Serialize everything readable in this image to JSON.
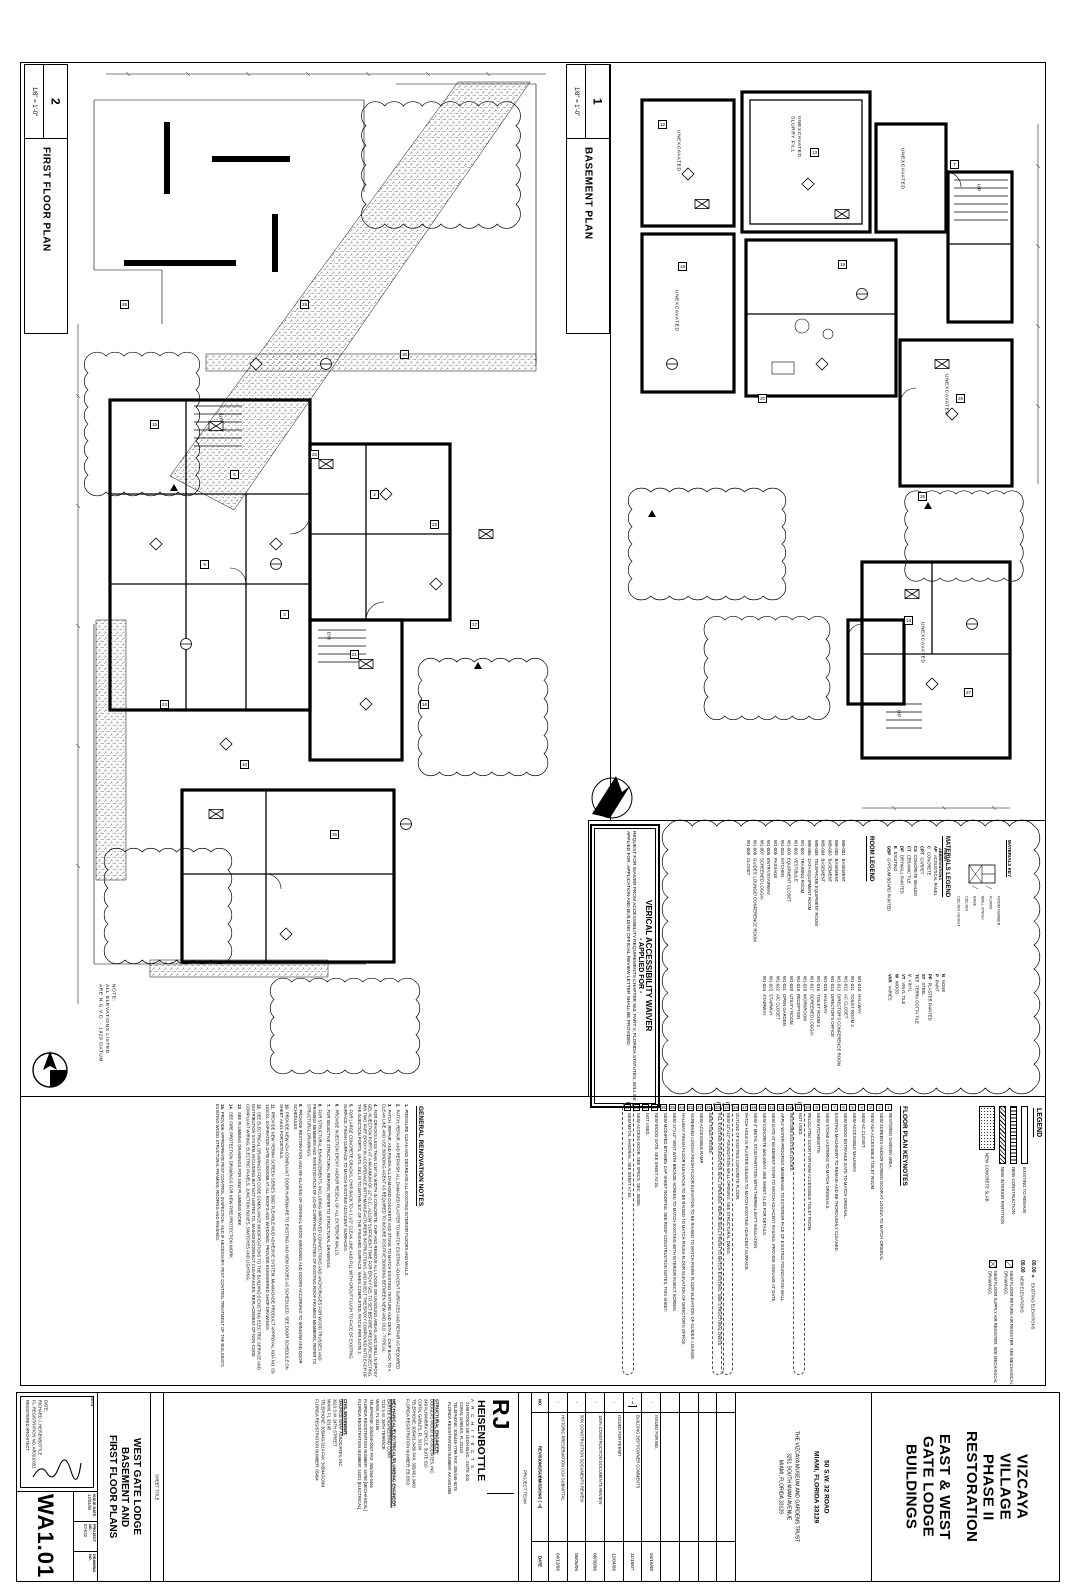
{
  "plans": {
    "first_floor": {
      "number": "2",
      "title": "FIRST FLOOR PLAN",
      "scale": "1/8\" = 1'-0\"",
      "labels": [
        {
          "text": "NOTE:\nALL ELEVATIONS LISTED\nARE N.G.V.D. - 1929 DATUM.",
          "x": 30,
          "y": 920
        },
        {
          "text": "UP",
          "x": 150,
          "y": 350
        },
        {
          "text": "DN",
          "x": 258,
          "y": 568
        }
      ],
      "tags": [
        {
          "n": "15",
          "x": 84,
          "y": 356
        },
        {
          "n": "5",
          "x": 164,
          "y": 406
        },
        {
          "n": "22",
          "x": 244,
          "y": 386
        },
        {
          "n": "2",
          "x": 304,
          "y": 426
        },
        {
          "n": "23",
          "x": 364,
          "y": 456
        },
        {
          "n": "9",
          "x": 134,
          "y": 496
        },
        {
          "n": "3",
          "x": 214,
          "y": 546
        },
        {
          "n": "21",
          "x": 284,
          "y": 586
        },
        {
          "n": "24",
          "x": 94,
          "y": 636
        },
        {
          "n": "10",
          "x": 174,
          "y": 696
        },
        {
          "n": "25",
          "x": 264,
          "y": 766
        },
        {
          "n": "16",
          "x": 354,
          "y": 636
        },
        {
          "n": "26",
          "x": 54,
          "y": 236
        },
        {
          "n": "29",
          "x": 234,
          "y": 236
        },
        {
          "n": "30",
          "x": 334,
          "y": 286
        },
        {
          "n": "17",
          "x": 404,
          "y": 556
        },
        {
          "n": "",
          "cls": "tri",
          "x": 104,
          "y": 420
        },
        {
          "n": "",
          "cls": "tri",
          "x": 408,
          "y": 598
        }
      ]
    },
    "basement": {
      "number": "1",
      "title": "BASEMENT PLAN",
      "scale": "1/8\" = 1'-0\"",
      "labels": [
        {
          "text": "UNEXCAVATED",
          "x": 62,
          "y": 66
        },
        {
          "text": "UNEXCAVATED\nSLURRY FILL",
          "x": 176,
          "y": 52
        },
        {
          "text": "UNEXCAVATED",
          "x": 60,
          "y": 226
        },
        {
          "text": "UNEXCAVATED",
          "x": 286,
          "y": 84
        },
        {
          "text": "UNEXCAVATED",
          "x": 330,
          "y": 310
        },
        {
          "text": "UNEXCAVATED",
          "x": 306,
          "y": 558
        },
        {
          "text": "UP",
          "x": 362,
          "y": 120
        },
        {
          "text": "UP",
          "x": 282,
          "y": 646
        }
      ],
      "tags": [
        {
          "n": "12",
          "x": 46,
          "y": 56
        },
        {
          "n": "13",
          "x": 198,
          "y": 84
        },
        {
          "n": "7",
          "x": 338,
          "y": 96
        },
        {
          "n": "18",
          "x": 66,
          "y": 198
        },
        {
          "n": "19",
          "x": 226,
          "y": 196
        },
        {
          "n": "25",
          "x": 344,
          "y": 330
        },
        {
          "n": "26",
          "x": 306,
          "y": 428
        },
        {
          "n": "20",
          "x": 146,
          "y": 330
        },
        {
          "n": "14",
          "x": 292,
          "y": 552
        },
        {
          "n": "27",
          "x": 352,
          "y": 624
        },
        {
          "n": "",
          "cls": "tri",
          "x": 36,
          "y": 446
        },
        {
          "n": "",
          "cls": "tri",
          "x": 312,
          "y": 438
        }
      ]
    }
  },
  "waiver": {
    "title": "VERICAL ACCESSIBILITY WAIVER",
    "subtitle": "- APPLIED FOR -",
    "body": "REQUEST FOR WAIVER FROM ACCESSIBILITY REQUIREMENTS CHAPTER 553, PART V, FLORIDA STATUTES, WILL BE APPLIED FOR. APPLICATION AND BUILDING OFFICIAL REVIEW LETTER SHALL BE PROVIDED."
  },
  "room_legend": {
    "title": "ROOM LEGEND",
    "group1": [
      {
        "no": "WB-001",
        "name": "BASEMENT"
      },
      {
        "no": "WB-002",
        "name": "BASEMENT"
      },
      {
        "no": "WB-003",
        "name": "BASEMENT"
      },
      {
        "no": "WB-004",
        "name": "BASEMENT"
      },
      {
        "no": "WB-005",
        "name": "TELEPHONE EQUIPMENT ROOM"
      },
      {
        "no": "WB-006",
        "name": "DATA EQUIPMENT ROOM"
      },
      {
        "no": "W1-001",
        "name": "TRAINING ROOM"
      },
      {
        "no": "W1-002",
        "name": "VESTIBULE"
      },
      {
        "no": "W1-003",
        "name": "EQUIPMENT CLOSET"
      },
      {
        "no": "W1-004",
        "name": "KITCHEN"
      },
      {
        "no": "W1-005",
        "name": "PASSAGE"
      },
      {
        "no": "W1-006",
        "name": "ENTRY/STAIRWAY"
      },
      {
        "no": "W1-007",
        "name": "SCREENED LOGGIA"
      },
      {
        "no": "W1-008",
        "name": "GUIDES' LOUNGE/ CONFERENCE ROOM"
      },
      {
        "no": "W1-009",
        "name": "CLOSET"
      }
    ],
    "group2": [
      {
        "no": "W1-010",
        "name": "HALLWAY"
      },
      {
        "no": "W1-011",
        "name": "TOILET ROOM 2"
      },
      {
        "no": "W1-012",
        "name": "AC CLOSET"
      },
      {
        "no": "W1-013",
        "name": "DIRECTOR'S CONFERENCE ROOM"
      },
      {
        "no": "W1-014",
        "name": "DIRECTOR'S OFFICE"
      },
      {
        "no": "W1-015",
        "name": "HALLWAY"
      },
      {
        "no": "W1-016",
        "name": "TOILET ROOM 1"
      },
      {
        "no": "W1-017",
        "name": "SCREENED LOGGIA"
      },
      {
        "no": "W1-018",
        "name": "WORKROOM"
      },
      {
        "no": "W1-019",
        "name": "RECEPTION"
      },
      {
        "no": "W1-020",
        "name": "UTILITY ROOM"
      },
      {
        "no": "W1-021",
        "name": "OPEN GARDEN"
      },
      {
        "no": "W1-022",
        "name": "A/C CLOSET"
      },
      {
        "no": "W1-023",
        "name": "STAIRWAY"
      },
      {
        "no": "W1-024",
        "name": "STAIRWAY"
      }
    ]
  },
  "materials_legend": {
    "title": "MATERIALS LEGEND",
    "col_header": "FINISH\nABBREVIATIONS",
    "materials": [
      {
        "abbr": "AP",
        "name": "ACOUSTICAL PANEL"
      },
      {
        "abbr": "C",
        "name": "CONCRETE"
      },
      {
        "abbr": "CPT",
        "name": "CARPET"
      },
      {
        "abbr": "CS",
        "name": "CONCRETE SEALED"
      },
      {
        "abbr": "CT",
        "name": "CERAMIC TILE"
      },
      {
        "abbr": "DP",
        "name": "DRYWALL PAINTED"
      },
      {
        "abbr": "E",
        "name": "EXISTING"
      },
      {
        "abbr": "GBP",
        "name": "GYPSUM BOARD PAINTED"
      }
    ],
    "finishes": [
      {
        "abbr": "N",
        "name": "NONE"
      },
      {
        "abbr": "P",
        "name": "PAINT"
      },
      {
        "abbr": "PP",
        "name": "PLASTER PAINTED"
      },
      {
        "abbr": "ST",
        "name": "STEEL"
      },
      {
        "abbr": "TCT",
        "name": "TERRA COTTA TILE"
      },
      {
        "abbr": "V",
        "name": "VINYL"
      },
      {
        "abbr": "VT",
        "name": "VINYL TILE"
      },
      {
        "abbr": "W",
        "name": "WOOD"
      },
      {
        "abbr": "VAR",
        "name": "VARIES"
      }
    ],
    "key": {
      "title": "MATERIALS KEY",
      "labels": [
        {
          "text": "ROOM NUMBER",
          "x": 42,
          "y": 58
        },
        {
          "text": "FLOOR",
          "x": 34,
          "y": 58
        },
        {
          "text": "WALL FINISH",
          "x": 26,
          "y": 58
        },
        {
          "text": "BASE",
          "x": 18,
          "y": 58
        },
        {
          "text": "CEILING",
          "x": 10,
          "y": 58
        },
        {
          "text": "CEILING HEIGHT",
          "x": 2,
          "y": 58
        }
      ]
    }
  },
  "legend": {
    "title": "LEGEND",
    "hatches": [
      {
        "name": "EXISTING TO REMAIN",
        "cls": "sw-plain"
      },
      {
        "name": "NEW CONSTRUCTION",
        "cls": "sw-ladder"
      },
      {
        "name": "NEW INTERIOR PARTITION",
        "cls": "sw-diag"
      },
      {
        "name": "NEW CONCRETE SLAB",
        "cls": "sw-stip"
      }
    ],
    "symbols": [
      {
        "glyph": "00.00 ×",
        "name": "EXISTING ELEVATIONS",
        "cls": "sym-text"
      },
      {
        "glyph": "00.00",
        "name": "NEW ELEVATIONS",
        "cls": "sym-text"
      },
      {
        "glyph": "⧄",
        "name": "NEW FLOOR RETURN AIR REGISTER. SEE MECHANICAL DRAWINGS.",
        "cls": "sym-ret"
      },
      {
        "glyph": "⊠",
        "name": "NEW FLOOR SUPPLY AIR REGISTER. SEE MECHANICAL DRAWINGS.",
        "cls": "sym-sup"
      }
    ]
  },
  "keynotes": {
    "title": "FLOOR PLAN KEYNOTES",
    "items": [
      {
        "n": "1",
        "text": "RESTORED GARDEN AREA."
      },
      {
        "n": "2",
        "text": "NEW SCREENS AND/OR SCREEN DOOR AT LOGGIA TO MATCH ORIGINAL."
      },
      {
        "n": "3",
        "text": "NEW ADA ACCESSIBLE TOILET ROOM."
      },
      {
        "n": "4",
        "text": "NEW AC CLOSET."
      },
      {
        "n": "5",
        "text": "NEW ACCESSIBLE WALKWAY."
      },
      {
        "n": "6",
        "text": "NEW WOOD ENTRANCE GATE TO MATCH ORIGINAL."
      },
      {
        "n": "7",
        "text": "EXISTING MACHINERY TO REMAIN AND BE THOROUGHLY CLEANED."
      },
      {
        "n": "8",
        "text": "NEW STONE LANTERNS TO MATCH ORIGINALS."
      },
      {
        "n": "9",
        "text": "NEW KITCHENETTE."
      },
      {
        "n": "10",
        "text": "RELOCATED DOOR FOR NEW ACCESSIBLE TOILET ROOM."
      },
      {
        "n": "11",
        "text": "NOT USED.",
        "cls": "clouded"
      },
      {
        "n": "12",
        "text": "RESTORE EXISTING DOORS."
      },
      {
        "n": "13",
        "text": "APPLY WATER-PROOFING MEMBRANE TO EXTERIOR FACE OF EXISTING FOUNDATION WALL."
      },
      {
        "n": "14",
        "text": "NEW GATE AT BASEMENT STAIR TO MATCH ADJACENT RAILING. PROVIDE SIGNAGE AT GATE."
      },
      {
        "n": "15",
        "text": "NEW CONCRETE WALKWAY. SEE SHEET A1.02 FOR DETAILS."
      },
      {
        "n": "16",
        "text": "NEW 4\" METAL STUD PARTITION WITH THERMAL BATT INSULATION."
      },
      {
        "n": "17",
        "text": "PATCH HOLE IN PLASTER CEILING TO MATCH EXISTING ADJACENT SURFACE."
      },
      {
        "n": "18",
        "text": "OUTLINE OF EXISTING CONCRETE FLOOR."
      },
      {
        "n": "19",
        "text": "NEW 12\"x12\" FOUNDATION WALL OPENING. SEE STRUCTURAL DWGS.",
        "cls": "clouded"
      },
      {
        "n": "20",
        "text": "FILL EXISTING FOUNDATION WALL OPENING. REPAIR WALL FINISH TO MATCH EXISTING. SEE STRUCTURAL DWGS.",
        "cls": "clouded"
      },
      {
        "n": "21",
        "text": "NEW TOILET ROOM."
      },
      {
        "n": "22",
        "text": "NEW ACCESSIBLE RAMP."
      },
      {
        "n": "23",
        "text": "SCREENED LOGGIA FINISH FLOOR ELEVATION TO BE RAISED TO MATCH FINISH FLOOR ELEVATION OF GUIDES' LOUNGE."
      },
      {
        "n": "24",
        "text": "HALLWAY FINISH FLOOR ELEVATION TO BE RAISED TO MATCH FINISH FLOOR ELEVATION OF DIRECTOR'S OFFICE."
      },
      {
        "n": "25",
        "text": "NEW 12\"x12\" VENT WITH BRONZE SCREEN TO MATCH EXISTING WITH INTERIOR INSECT SCREEN."
      },
      {
        "n": "26",
        "text": "NEW MODIFIED BITUMEN CAP SHEET ROOFING. SEE ROOF CONSTRUCTION NOTES, THIS SHEET."
      },
      {
        "n": "27",
        "text": "NEW WOOD GATE. SEE SHEET A2.04."
      },
      {
        "n": "28",
        "text": "NOT USED."
      },
      {
        "n": "29",
        "text": "NEW ACCESS DOOR. SEE SPECS. SEC. 08305."
      },
      {
        "n": "30",
        "text": "NEW METAL HANDRAIL. SEE SHEET A7.04.",
        "cls": "clouded"
      }
    ]
  },
  "general_notes": {
    "title": "GENERAL RENOVATION NOTES",
    "items": [
      {
        "n": "1.",
        "text": "PRESSURE CLEAN AND DEGREASE ALL EXISTING INTERIOR FLOORS AND WALLS."
      },
      {
        "n": "2.",
        "text": "PATCH, REPAIR, AND REFINISH ALL DAMAGED PLASTER TO MATCH EXISTING ADJACENT SURFACES AND REPAIR AS REQUIRED."
      },
      {
        "n": "3.",
        "text": "PATCH, REPAIR, AND FINISH ALL DAMAGED CONCRETE AND STONE TO MATCH EXISTING TEXTURE AND DETAIL. CHIP BACK TO A CLEAN LINE AND USE BONDING AGENT AS REQUIRED TO INSURE POSITIVE BONDING BETWEEN NEW AND OLD - TYPICAL."
      },
      {
        "n": "4.",
        "text": "FOR CRACKS LESS THAN 1/16\" IN WIDTH IN CONCRETE, CHIP AND REMOVE ALL LOOSE OR UNSOUND AREAS, AND DRILL IN EPOXY GEL INJECTION PORTS AT A MAXIMUM OF 12\" O.C., ALLOW SUFFICIENT TIME FOR EPOXY GEL TO SET BEFORE PRESSURE INJECTING, MIX TWO PART EPOXY IN ACCORDANCE WITH MANUFACTURERS INSTRUCTIONS, AND INJECT THE EPOXY COMPOUND INTO EACH OF THE INJECTION PORTS, UNTIL GEL IS TO WITHIN 3/4\" OF THE FINISHED SURFACE. WHEN COMPLETED, PATCH PER NOTE 2."
      },
      {
        "n": "5.",
        "text": "FOR LARGE CONCRETE CRACKS, CHIP BACK TO A 1-1/2\" CLEAN LINE AND FILL WITH GROUT FLUSH TO FACE OF EXISTING SURFACE. FINISH SURFACE TO MATCH EXISTING ADJACENT SURFACES."
      },
      {
        "n": "6.",
        "text": "PROVIDE INJECTION EPOXY AND/OR RESEAL OF ALL EXTERIOR WALLS."
      },
      {
        "n": "7.",
        "text": "FOR SELECTIVE STRUCTURAL REPAIRS, REFER TO STRUCTURAL DRAWINGS."
      },
      {
        "n": "8.",
        "text": "FOR STRUCTURAL ENHANCEMENTS, INCLUDING IMPROVED CONNECTIONS AND ANCHORAGES FOR WOOD TRUSSES AND FRAMING MEMBERS AND INVESTIGATION OF LOAD CARRYING CAPACITIES OF EXISTING ROOF FRAMING MEMBERS, REFER TO STRUCTURAL DRAWINGS."
      },
      {
        "n": "9.",
        "text": "PROVIDE RESTORATION AND RE-GLAZING OF ORIGINAL WOOD WINDOWS AND DOORS ACCORDING TO WINDOW AND DOOR SCHEDULES."
      },
      {
        "n": "10.",
        "text": "PROVIDE NEW ADA COMPLIANT DOOR HARDWARE TO EXISTING AND NEW DOORS AS SCHEDULED. SEE DOOR SCHEDULE ON SHEET A6.01 FOR DETAILS."
      },
      {
        "n": "11.",
        "text": "PROVIDE NEW 'PERMA SCREEN SERIES 3000' FLEXIBLE MUD ADHESIVE SYSTEM, MIAMI-DADE PRODUCT APPROVAL NOA NO. 03-1104.01, EXPIRATION DATE 01/30/2008 AT ALL ROOFS AND WINDOWS. PROVIDE ENGINEERED SHOP DRAWINGS."
      },
      {
        "n": "12.",
        "text": "SEE ELECTRICAL DRAWINGS FOR CODE COMPLIANCE MODIFICATIONS TO THE BUILDING'S EXISTING ELECTRIC SERVICE AND DISTRIBUTION SYSTEM, INCLUDING BUT NOT LIMITED TO, MAIN/DISCONNECT CLEARANCES, REPLACEMENT OF NON-CODE COMPLIANT WIRING, ELECTRIC PANELS, JUNCTION BOXES, SWITCHES AND LIGHTING."
      },
      {
        "n": "13.",
        "text": "SEE PLUMBING DRAWINGS FOR NEW PLUMBING WORK."
      },
      {
        "n": "14.",
        "text": "SEE FIRE PROTECTION DRAWINGS FOR NEW FIRE PROTECTION WORK."
      },
      {
        "n": "15.",
        "text": "PROVIDE APPROPRIATE PEST CONTROL, INSPECTION, AND IF NECESSARY, PEST CONTROL TREATMENT OF THE BUILDING'S EXISTING WOOD STRUCTURAL FRAMING, ROOFING AND FINISHES."
      }
    ]
  },
  "title_block": {
    "seal_label": "SEAL",
    "seal_lines": "DATE:\nRICHARD J. HEISENBOTTLE\nFL. REGISTRATION NO. AR0010352\nREGISTERED ARCHITECT",
    "fields": [
      {
        "label": "ISSUE DATE",
        "value": "12/04/06"
      },
      {
        "label": "PROJECT NO.",
        "value": "03-032"
      },
      {
        "label": "DRAWING NO.",
        "value": ""
      }
    ],
    "drawing_no": "WA1.01",
    "sheet_title_label": "SHEET TITLE",
    "sheet_title": "WEST GATE LODGE\nBASEMENT AND\nFIRST FLOOR PLANS",
    "project_team_label": "PROJECT TEAM",
    "firm": {
      "initials": "RJ",
      "name": "HEISENBOTTLE",
      "subtitle": "A R C H I T E C T S",
      "address": "2199 PONCE DE LEON BLVD., SUITE 400\nCORAL GABLES, FL 33134\nTELEPHONE: 305/446-7799   FAX: 305/446-9275\nFLORIDA REGISTRATION NUMBER: AA 0001885"
    },
    "engineers": [
      {
        "heading": "STRUCTURAL ENGINEER:",
        "lines": "DOUGLAS WOOD & ASSOCIATES, INC.\n249 ALHAMBRA CIRCLE, SUITE 510\nCORAL GABLES, FL 33134\nTELEPHONE: 305/461-3450   FAX: 305/461-3460\nFLORIDA REGISTRATION NUMBER: EB 6553"
      },
      {
        "heading": "MECHANICAL/ELECTRICAL/PLUMBING ENGINEER:",
        "lines": "BARTEK ENGINEERING CORP.\n7210 S.W. 39TH TERRACE\nMIAMI, FL 33155\nTELEPHONE: 305/266-0067   FAX: 305/264-0466\nFLORIDA REGISTRATION NUMBER: 34788 [MECHANICAL]\nFLORIDA REGISTRATION NUMBER: 24321 [ELECTRICAL]"
      },
      {
        "heading": "CIVIL ENGINEER:",
        "lines": "MAURICE GRAY ASSOCIATES, INC.\n3923 S.W. 24TH STREET\nMIAMI, FL 33145\nTELEPHONE: 305/443-3114   FAX: 305/443-0364\nFLORIDA REGISTRATION NUMBER: 05404"
      }
    ],
    "rev_headers": {
      "no": "NO.",
      "desc": "REVISIONS/SUBMISSIONS (△)",
      "date": "DATE"
    },
    "revisions": [
      {
        "no": "",
        "desc": "",
        "date": ""
      },
      {
        "no": "",
        "desc": "",
        "date": ""
      },
      {
        "no": "",
        "desc": "",
        "date": ""
      },
      {
        "no": "",
        "desc": "",
        "date": ""
      },
      {
        "no": "-",
        "desc": "ISSUED FOR BID.",
        "date": "04/16/08"
      },
      {
        "no": "1",
        "desc": "BUILDING DEPT/OWNER COMMENTS",
        "date": "11/16/07",
        "cls": "has-tri"
      },
      {
        "no": "-",
        "desc": "ISSUED FOR PERMIT",
        "date": "12/04/06"
      },
      {
        "no": "-",
        "desc": "100% CONSTRUCTION DOCUMENTS REVIEW",
        "date": "06/30/06"
      },
      {
        "no": "-",
        "desc": "50% CONSTRUCTION DOCUMENTS REVIEW",
        "date": "05/05/06"
      },
      {
        "no": "-",
        "desc": "HISTORIC PRESERVATION COA SUBMITTAL",
        "date": "04/13/06"
      }
    ],
    "owner_site": "50 S.W. 32 ROAD\nMIAMI, FLORIDA 33129",
    "owner_client": "THE VIZCAYA MUSEUM AND GARDENS TRUST\n3251 SOUTH MIAMI AVENUE\nMIAMI, FLORIDA 33129",
    "project_name_1": "VIZCAYA\nVILLAGE\nPHASE II\nRESTORATION",
    "project_name_2": "EAST & WEST\nGATE LODGE\nBUILDINGS"
  }
}
